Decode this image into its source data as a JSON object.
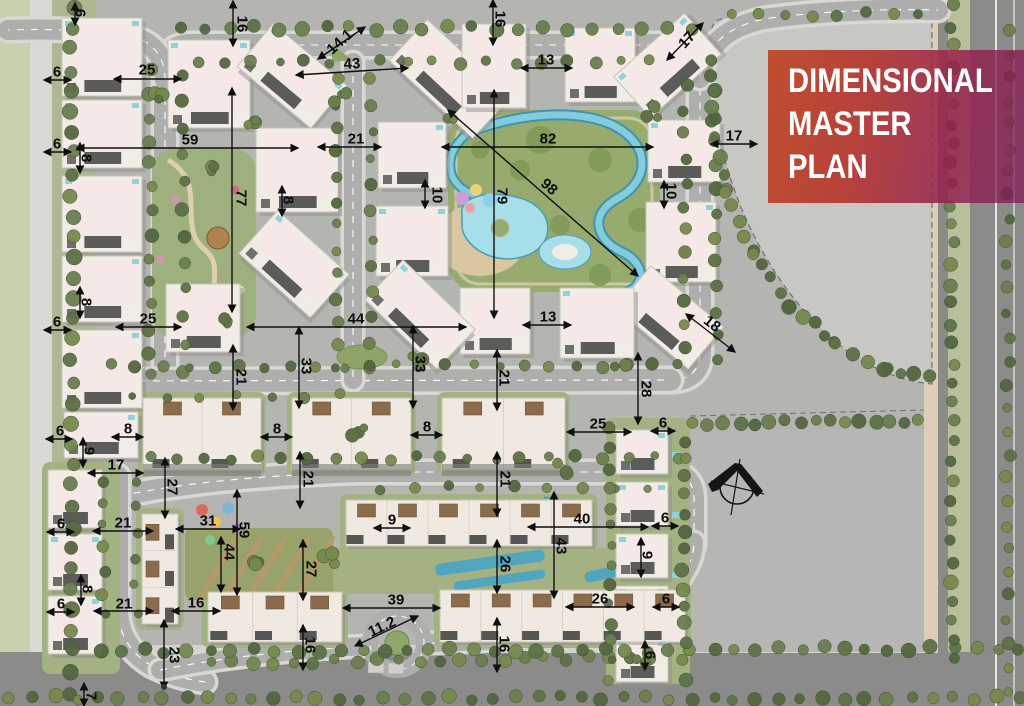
{
  "title_block": {
    "lines": [
      "DIMENSIONAL",
      "MASTER",
      "PLAN"
    ]
  },
  "colors": {
    "title_gradient_start": "#c04a2b",
    "title_gradient_end": "#8e1c50",
    "title_text": "#ffffff",
    "dimension_text": "#0c0c0c",
    "road": "#aeaeac",
    "building": "#f1ece6",
    "pool": "#7fc9da",
    "lawn": "#97ab6f",
    "parcel": "#c7c7c4"
  },
  "compass": {
    "icon": "north-arrow"
  },
  "dimensions": [
    {
      "v": "6",
      "x": 80,
      "y": 13,
      "r": 90,
      "l": [
        75,
        3,
        75,
        25
      ]
    },
    {
      "v": "16",
      "x": 242,
      "y": 24,
      "r": 90,
      "l": [
        233,
        1,
        233,
        46
      ]
    },
    {
      "v": "14.1",
      "x": 340,
      "y": 42,
      "r": -42,
      "l": [
        318,
        59,
        365,
        27
      ]
    },
    {
      "v": "43",
      "x": 352,
      "y": 64,
      "r": -3,
      "l": [
        296,
        75,
        408,
        68
      ]
    },
    {
      "v": "16",
      "x": 500,
      "y": 19,
      "r": 90,
      "l": [
        493,
        0,
        493,
        45
      ]
    },
    {
      "v": "13",
      "x": 546,
      "y": 60,
      "r": 0,
      "l": [
        521,
        68,
        572,
        68
      ]
    },
    {
      "v": "17",
      "x": 687,
      "y": 40,
      "r": -48,
      "l": [
        667,
        60,
        703,
        23
      ]
    },
    {
      "v": "6",
      "x": 57,
      "y": 72,
      "r": 0,
      "l": [
        44,
        80,
        71,
        80
      ]
    },
    {
      "v": "25",
      "x": 147,
      "y": 70,
      "r": 0,
      "l": [
        114,
        79,
        181,
        79
      ]
    },
    {
      "v": "6",
      "x": 57,
      "y": 144,
      "r": 0,
      "l": [
        44,
        152,
        71,
        152
      ]
    },
    {
      "v": "59",
      "x": 190,
      "y": 140,
      "r": 0,
      "l": [
        77,
        148,
        298,
        148
      ]
    },
    {
      "v": "8",
      "x": 86,
      "y": 158,
      "r": 90,
      "l": [
        80,
        143,
        80,
        173
      ]
    },
    {
      "v": "21",
      "x": 356,
      "y": 139,
      "r": 0,
      "l": [
        318,
        147,
        381,
        147
      ]
    },
    {
      "v": "82",
      "x": 548,
      "y": 139,
      "r": 0,
      "l": [
        442,
        147,
        653,
        147
      ]
    },
    {
      "v": "17",
      "x": 734,
      "y": 136,
      "r": 0,
      "l": [
        711,
        144,
        757,
        144
      ]
    },
    {
      "v": "77",
      "x": 241,
      "y": 198,
      "r": 90,
      "l": [
        232,
        88,
        232,
        312
      ]
    },
    {
      "v": "8",
      "x": 288,
      "y": 200,
      "r": 90,
      "l": [
        282,
        186,
        282,
        216
      ]
    },
    {
      "v": "10",
      "x": 437,
      "y": 195,
      "r": 90,
      "l": [
        425,
        180,
        425,
        208
      ]
    },
    {
      "v": "79",
      "x": 502,
      "y": 196,
      "r": 90,
      "l": [
        494,
        90,
        494,
        318
      ]
    },
    {
      "v": "98",
      "x": 549,
      "y": 187,
      "r": 41,
      "l": [
        448,
        110,
        638,
        276
      ]
    },
    {
      "v": "10",
      "x": 671,
      "y": 191,
      "r": 90,
      "l": [
        664,
        181,
        664,
        208
      ]
    },
    {
      "v": "8",
      "x": 86,
      "y": 302,
      "r": 90,
      "l": [
        80,
        287,
        80,
        318
      ]
    },
    {
      "v": "6",
      "x": 57,
      "y": 322,
      "r": 0,
      "l": [
        44,
        330,
        71,
        330
      ]
    },
    {
      "v": "25",
      "x": 148,
      "y": 319,
      "r": 0,
      "l": [
        116,
        327,
        181,
        327
      ]
    },
    {
      "v": "18",
      "x": 712,
      "y": 324,
      "r": 38,
      "l": [
        686,
        314,
        735,
        352
      ]
    },
    {
      "v": "21",
      "x": 241,
      "y": 377,
      "r": 90,
      "l": [
        233,
        345,
        233,
        410
      ]
    },
    {
      "v": "33",
      "x": 306,
      "y": 366,
      "r": 90,
      "l": [
        299,
        327,
        299,
        408
      ]
    },
    {
      "v": "44",
      "x": 356,
      "y": 319,
      "r": 0,
      "l": [
        247,
        327,
        466,
        327
      ]
    },
    {
      "v": "33",
      "x": 420,
      "y": 364,
      "r": 90,
      "l": [
        413,
        326,
        413,
        408
      ]
    },
    {
      "v": "13",
      "x": 548,
      "y": 317,
      "r": 0,
      "l": [
        523,
        325,
        571,
        325
      ]
    },
    {
      "v": "21",
      "x": 504,
      "y": 378,
      "r": 90,
      "l": [
        497,
        350,
        497,
        410
      ]
    },
    {
      "v": "28",
      "x": 646,
      "y": 389,
      "r": 90,
      "l": [
        638,
        353,
        638,
        424
      ]
    },
    {
      "v": "6",
      "x": 60,
      "y": 431,
      "r": 0,
      "l": [
        46,
        439,
        72,
        439
      ]
    },
    {
      "v": "8",
      "x": 128,
      "y": 429,
      "r": 0,
      "l": [
        112,
        437,
        143,
        437
      ]
    },
    {
      "v": "8",
      "x": 277,
      "y": 429,
      "r": 0,
      "l": [
        261,
        437,
        292,
        437
      ]
    },
    {
      "v": "8",
      "x": 427,
      "y": 427,
      "r": 0,
      "l": [
        411,
        435,
        442,
        435
      ]
    },
    {
      "v": "25",
      "x": 598,
      "y": 424,
      "r": 0,
      "l": [
        567,
        432,
        631,
        432
      ]
    },
    {
      "v": "6",
      "x": 663,
      "y": 423,
      "r": 0,
      "l": [
        651,
        431,
        675,
        431
      ]
    },
    {
      "v": "9",
      "x": 89,
      "y": 451,
      "r": 90,
      "l": [
        83,
        438,
        83,
        467
      ]
    },
    {
      "v": "17",
      "x": 116,
      "y": 465,
      "r": 0,
      "l": [
        88,
        473,
        143,
        473
      ]
    },
    {
      "v": "27",
      "x": 172,
      "y": 487,
      "r": 90,
      "l": [
        165,
        458,
        165,
        518
      ]
    },
    {
      "v": "21",
      "x": 308,
      "y": 479,
      "r": 90,
      "l": [
        300,
        452,
        300,
        508
      ]
    },
    {
      "v": "21",
      "x": 505,
      "y": 479,
      "r": 90,
      "l": [
        497,
        452,
        497,
        516
      ]
    },
    {
      "v": "6",
      "x": 61,
      "y": 524,
      "r": 0,
      "l": [
        47,
        532,
        74,
        532
      ]
    },
    {
      "v": "21",
      "x": 123,
      "y": 523,
      "r": 0,
      "l": [
        93,
        531,
        153,
        531
      ]
    },
    {
      "v": "31",
      "x": 208,
      "y": 521,
      "r": 0,
      "l": [
        176,
        529,
        240,
        529
      ]
    },
    {
      "v": "59",
      "x": 244,
      "y": 530,
      "r": 90,
      "l": [
        237,
        490,
        237,
        595
      ]
    },
    {
      "v": "44",
      "x": 229,
      "y": 552,
      "r": 90,
      "l": [
        221,
        537,
        221,
        592
      ]
    },
    {
      "v": "9",
      "x": 392,
      "y": 520,
      "r": 0,
      "l": [
        374,
        528,
        410,
        528
      ]
    },
    {
      "v": "40",
      "x": 582,
      "y": 519,
      "r": 0,
      "l": [
        528,
        527,
        648,
        527
      ]
    },
    {
      "v": "6",
      "x": 665,
      "y": 518,
      "r": 0,
      "l": [
        652,
        526,
        678,
        526
      ]
    },
    {
      "v": "27",
      "x": 311,
      "y": 569,
      "r": 90,
      "l": [
        303,
        540,
        303,
        600
      ]
    },
    {
      "v": "43",
      "x": 561,
      "y": 546,
      "r": 90,
      "l": [
        554,
        492,
        554,
        598
      ]
    },
    {
      "v": "26",
      "x": 505,
      "y": 564,
      "r": 90,
      "l": [
        497,
        540,
        497,
        593
      ]
    },
    {
      "v": "9",
      "x": 647,
      "y": 555,
      "r": 90,
      "l": [
        641,
        538,
        641,
        577
      ]
    },
    {
      "v": "8",
      "x": 87,
      "y": 589,
      "r": 90,
      "l": [
        81,
        575,
        81,
        605
      ]
    },
    {
      "v": "6",
      "x": 61,
      "y": 604,
      "r": 0,
      "l": [
        47,
        612,
        74,
        612
      ]
    },
    {
      "v": "21",
      "x": 124,
      "y": 604,
      "r": 0,
      "l": [
        94,
        611,
        153,
        611
      ]
    },
    {
      "v": "16",
      "x": 196,
      "y": 603,
      "r": 0,
      "l": [
        172,
        611,
        220,
        611
      ]
    },
    {
      "v": "39",
      "x": 396,
      "y": 600,
      "r": 0,
      "l": [
        343,
        608,
        440,
        608
      ]
    },
    {
      "v": "26",
      "x": 600,
      "y": 599,
      "r": 0,
      "l": [
        566,
        607,
        634,
        607
      ]
    },
    {
      "v": "6",
      "x": 666,
      "y": 599,
      "r": 0,
      "l": [
        653,
        607,
        679,
        607
      ]
    },
    {
      "v": "11.2",
      "x": 382,
      "y": 627,
      "r": -25,
      "l": [
        355,
        646,
        418,
        616
      ]
    },
    {
      "v": "23",
      "x": 174,
      "y": 655,
      "r": 90,
      "l": [
        164,
        620,
        164,
        689
      ]
    },
    {
      "v": "16",
      "x": 310,
      "y": 645,
      "r": 90,
      "l": [
        303,
        625,
        303,
        670
      ]
    },
    {
      "v": "16",
      "x": 504,
      "y": 644,
      "r": 90,
      "l": [
        497,
        618,
        497,
        672
      ]
    },
    {
      "v": "6",
      "x": 650,
      "y": 655,
      "r": 90,
      "l": [
        645,
        641,
        645,
        670
      ]
    },
    {
      "v": "7",
      "x": 91,
      "y": 696,
      "r": 90,
      "l": [
        84,
        683,
        84,
        706
      ]
    }
  ]
}
